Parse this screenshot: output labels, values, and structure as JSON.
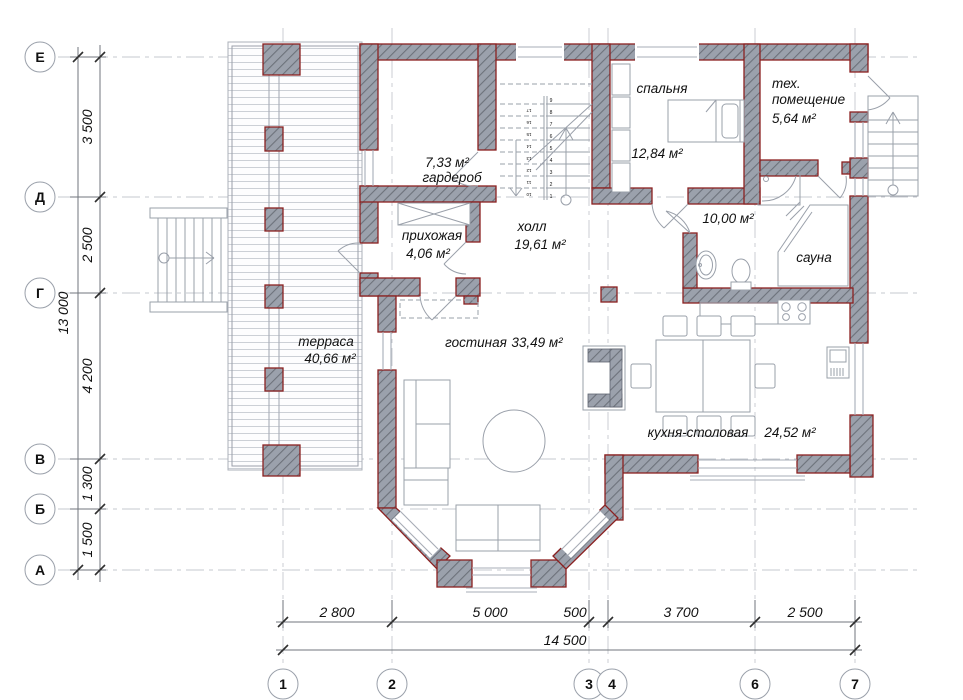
{
  "drawing": {
    "type": "architectural floor plan, ground floor"
  },
  "axes": {
    "rows": [
      "Е",
      "Д",
      "Г",
      "В",
      "Б",
      "А"
    ],
    "cols": [
      "1",
      "2",
      "3",
      "4",
      "6",
      "7"
    ]
  },
  "dims": {
    "left": [
      "3 500",
      "2 500",
      "4 200",
      "1 300",
      "1 500"
    ],
    "left_total": "13 000",
    "bottom": [
      "2 800",
      "5 000",
      "500",
      "3 700",
      "2 500"
    ],
    "bottom_total": "14 500"
  },
  "rooms": {
    "wardrobe": {
      "area": "7,33 м²",
      "name": "гардероб"
    },
    "entry": {
      "name": "прихожая",
      "area": "4,06 м²"
    },
    "hall": {
      "name": "холл",
      "area": "19,61 м²"
    },
    "bedroom": {
      "name": "спальня",
      "area": "12,84 м²"
    },
    "tech1": "тех.",
    "tech2": "помещение",
    "tech_area": "5,64 м²",
    "bath_area": "10,00 м²",
    "sauna": "сауна",
    "terrace": {
      "name": "терраса",
      "area": "40,66 м²"
    },
    "living": {
      "name": "гостиная",
      "area": "33,49 м²"
    },
    "kitchen": {
      "name": "кухня-столовая",
      "area": "24,52 м²"
    }
  },
  "stair": {
    "right": [
      "1",
      "2",
      "3",
      "4",
      "5",
      "6",
      "7",
      "8",
      "9"
    ],
    "left": [
      "10",
      "11",
      "12",
      "13",
      "14",
      "15",
      "16",
      "17"
    ]
  },
  "colors": {
    "wall_fill": "#9ba1ac",
    "wall_edge": "#8b2121",
    "thin_line": "#9aa0aa",
    "grid_line": "#c6c9cf",
    "text": "#111111"
  }
}
